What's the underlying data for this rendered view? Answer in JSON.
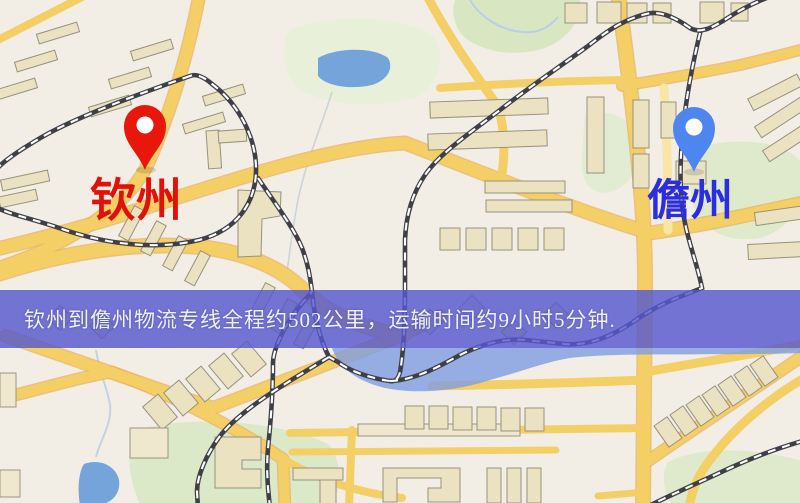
{
  "page": {
    "type": "logistics-route-map-graphic"
  },
  "banner": {
    "text": "钦州到儋州物流专线全程约502公里，运输时间约9小时5分钟.",
    "bg_color": "#5658ce",
    "text_color": "#f1f1ea"
  },
  "route": {
    "origin": "钦州",
    "destination": "儋州",
    "distance_text": "约502公里",
    "duration_text": "约9小时5分钟"
  },
  "markers": {
    "origin": {
      "label": "钦州",
      "pin_color": "#e7170c",
      "label_color": "#df1108"
    },
    "destination": {
      "label": "儋州",
      "pin_color": "#4e86f0",
      "label_color": "#2b2de0"
    }
  },
  "map": {
    "background_color": "#f2eee6",
    "road_color": "#f4cf66",
    "park_color": "#e0ebcf",
    "water_color": "#74a4da",
    "railway_color": "#3f3f48",
    "building_color": "#ebe2c2"
  }
}
